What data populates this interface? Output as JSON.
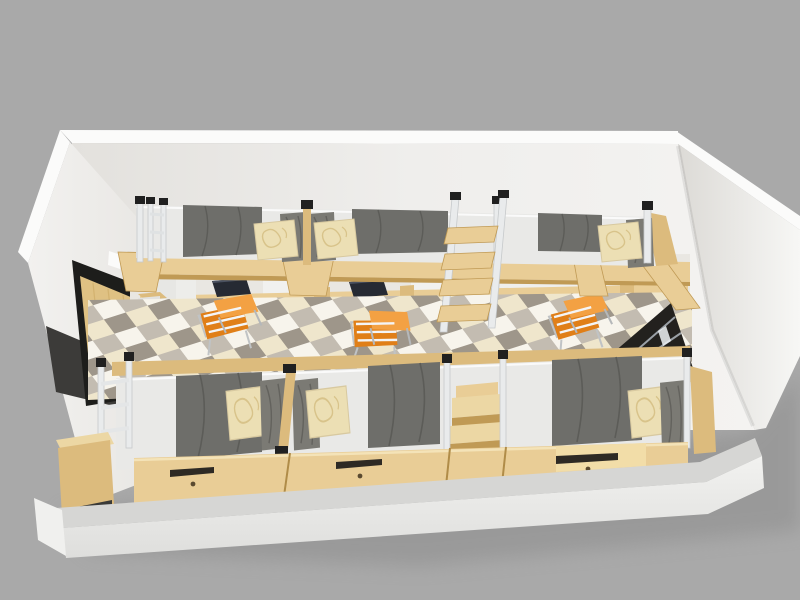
{
  "scene": {
    "description": "3D axonometric cutaway render of a dormitory room with three loft beds over desks along the back wall and three beds with drawer bases in front, diagonal checkered floor, wooden door on the left wall and a dark blinded window on the right wall",
    "view": "aerial cutaway, front wall removed",
    "objects": {
      "loft_beds": 3,
      "lower_beds": 3,
      "desks": 3,
      "desk_chairs": 3,
      "wardrobe_panels": 2,
      "laptops_on_desks": 2,
      "wood_ladder": 1,
      "wood_step_unit": 1,
      "metal_end_guards": 2,
      "under_bed_drawers": 3,
      "door": 1,
      "window": 1,
      "cream_pillows": 6,
      "gray_pillows": 6,
      "light_switch": 1,
      "corner_shelf_steps": 1
    }
  },
  "palette": {
    "background": "#a9a9a9",
    "shadow": "#8a8a8a",
    "wall_bright": "#fbfbfa",
    "wall_light": "#f1f0ee",
    "wall_mid": "#e6e4e0",
    "wood": "#e9cd96",
    "wood_mid": "#dcbb7d",
    "wood_dark": "#c09a55",
    "mattress": "#6e6e6a",
    "mattress_dark": "#5c5c58",
    "sheet": "#e9e9e7",
    "pillow_cream": "#ecdfb4",
    "pillow_cream_pattern": "#d8c38a",
    "pillow_gray": "#7b7a74",
    "metal": "#e9ebec",
    "metal_dark": "#202020",
    "panel_white": "#f1f1ef",
    "panel_side": "#d8d8d6",
    "laptop_dark": "#262a33",
    "chair_orange": "#e8891f",
    "chair_orange_light": "#f3a143",
    "chair_frame": "#f4f5f6",
    "door_black": "#1d1d1b",
    "door_wood": "#dfc183",
    "window_dark": "#23211e",
    "window_slat": "#9aa0a6",
    "floor_cream": "#efe6cc",
    "floor_white": "#f7f4ec",
    "floor_taupe": "#9e968a",
    "floor_gray": "#c3bcb1",
    "slab_top": "#d6d6d4",
    "slab_front": "#f0f0ee",
    "drawer_slot": "#2e2a24"
  }
}
